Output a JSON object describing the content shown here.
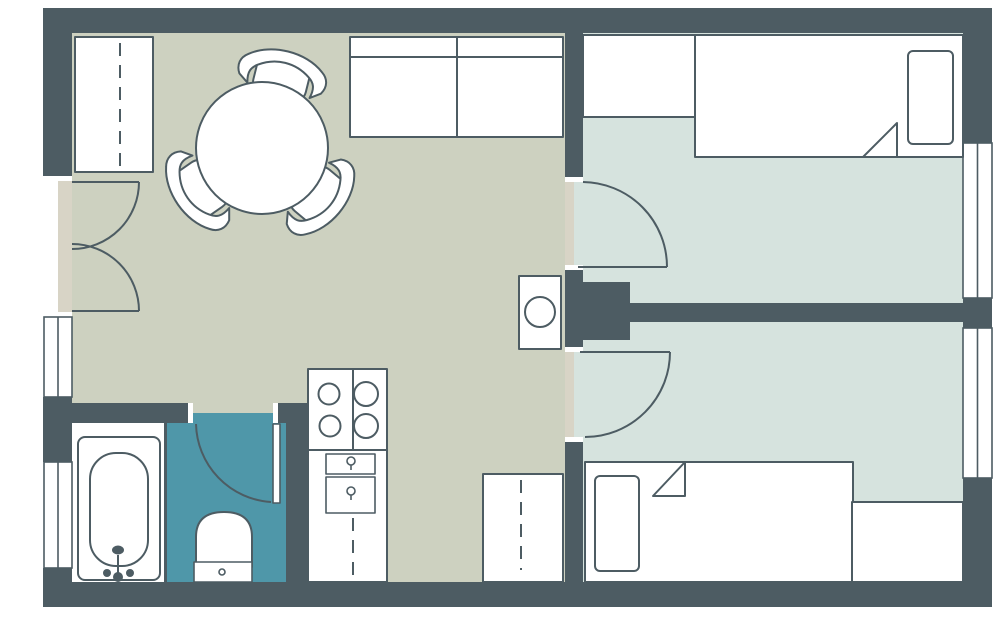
{
  "colors": {
    "wall": "#4d5c63",
    "outline": "#4d5c63",
    "living_floor": "#cdd1c0",
    "bedroom_floor": "#d6e3de",
    "wc_floor": "#4f97a9",
    "bathroom_floor": "#ffffff",
    "threshold": "#d8d4c6",
    "background": "#ffffff"
  },
  "plan": {
    "rooms": [
      {
        "name": "living-kitchen",
        "floor_color": "#cdd1c0"
      },
      {
        "name": "bedroom-top",
        "floor_color": "#d6e3de"
      },
      {
        "name": "bedroom-bottom",
        "floor_color": "#d6e3de"
      },
      {
        "name": "bathroom",
        "floor_color": "#ffffff"
      },
      {
        "name": "wc",
        "floor_color": "#4f97a9"
      }
    ],
    "icons": [
      "wardrobe-icon",
      "dining-table-icon",
      "chair-icon",
      "sofa-icon",
      "washing-machine-icon",
      "cooktop-icon",
      "kitchen-cabinet-icon",
      "bathtub-icon",
      "toilet-icon",
      "bed-icon",
      "closet-icon",
      "dresser-icon",
      "door-swing-icon",
      "window-icon"
    ],
    "counts": {
      "chairs": 3,
      "beds": 2,
      "windows": 4,
      "doors": 6
    }
  }
}
